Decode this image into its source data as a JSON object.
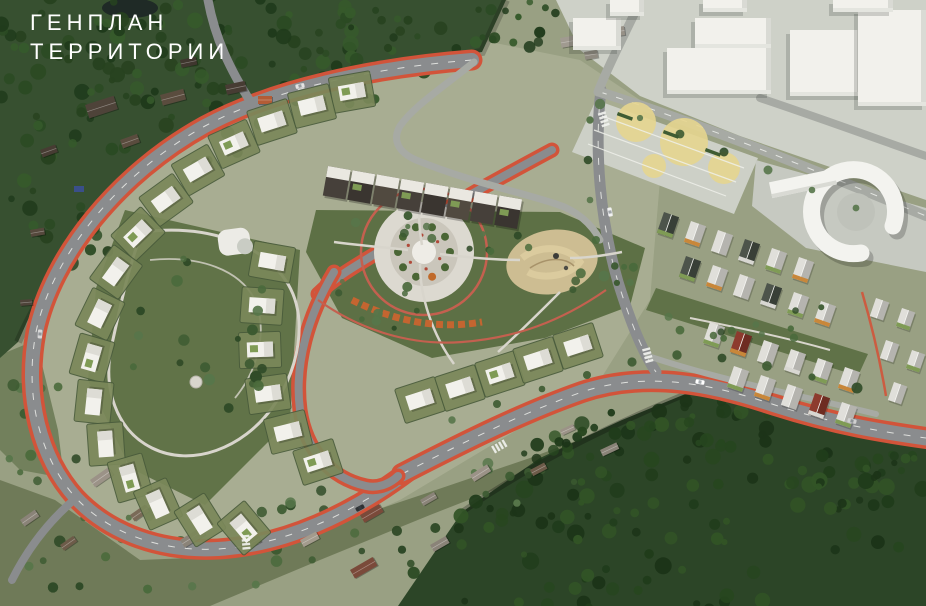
{
  "header": {
    "title_line1": "ГЕНПЛАН",
    "title_line2": "ТЕРРИТОРИИ"
  },
  "scene": {
    "kind": "aerial-3d-masterplan-render",
    "regions": [
      "existing-forest-northwest",
      "existing-village-northwest",
      "ring-road-with-orange-bike-lane",
      "cottage-district-inside-ring",
      "landscaped-loop-park-west",
      "central-park-with-circular-plaza",
      "sand-playground",
      "dark-townhouse-row-center",
      "gable-townhouse-rows-east",
      "red-accent-houses",
      "city-blocks-northeast",
      "horseshoe-school-building",
      "parking-lot-with-yellow-circles",
      "main-avenue-southeast",
      "existing-village-south",
      "forest-southeast"
    ]
  },
  "palette": {
    "base_land": "#99a083",
    "development_ground": "#a9ae92",
    "city_ground": "#ced1c8",
    "plaza_ground": "#c6c9c1",
    "parking_ground": "#cdd0c7",
    "park_green": "#5d7045",
    "lawn_green": "#7b885a",
    "road_asphalt": "#8a8c8e",
    "road_light": "#a7aaa4",
    "bike_lane_orange": "#d2543a",
    "building_white": "#f2f1ec",
    "roof_gray": "#e0dfda",
    "roof_side": "#b5b4af",
    "townhouse_dark": "#46403a",
    "red_house": "#8d3b2e",
    "sand": "#cdbd92",
    "parking_yellow": "#e6d58f",
    "path_light": "#d8d5cc",
    "path_red": "#c4604f",
    "green_roof": "#7f9b55",
    "water": "#3a4f8a",
    "title_text": "#ffffff",
    "forest_shades": [
      "#1f3a1b",
      "#2b4a23",
      "#365a2b",
      "#27421f"
    ],
    "deep_forest_shades": [
      "#1c3418",
      "#27461f",
      "#325426",
      "#203c1b"
    ],
    "tree_shades": [
      "#3c5a31",
      "#4a6a3c",
      "#57764a",
      "#2f4a27"
    ]
  }
}
